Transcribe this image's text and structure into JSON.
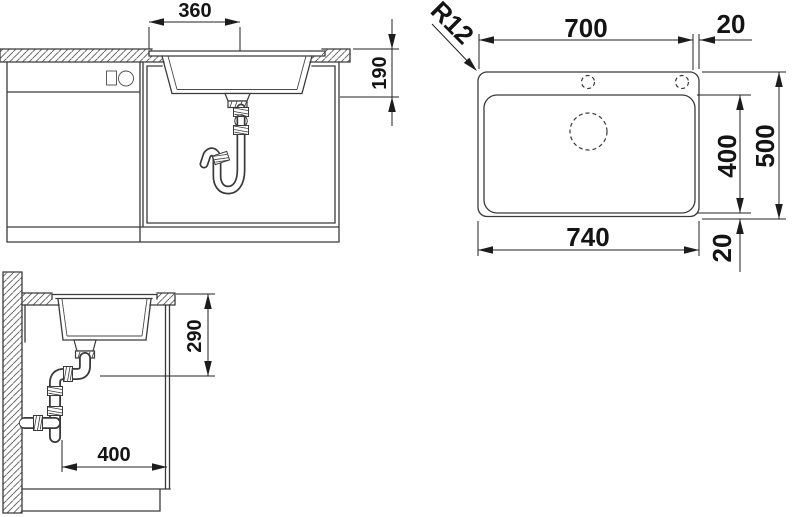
{
  "drawing": {
    "front_view": {
      "drain_offset_width": "360",
      "bowl_depth": "190"
    },
    "top_view": {
      "top_width": "700",
      "right_edge_gap": "20",
      "corner_radius": "R12",
      "bowl_length": "400",
      "overall_depth": "500",
      "overall_width": "740",
      "bottom_edge_gap": "20"
    },
    "side_view": {
      "drain_height_below_top": "290",
      "clearance_depth": "400"
    }
  },
  "colors": {
    "line": "#3a3a3a",
    "dimension_text": "#141414",
    "background": "#ffffff"
  }
}
